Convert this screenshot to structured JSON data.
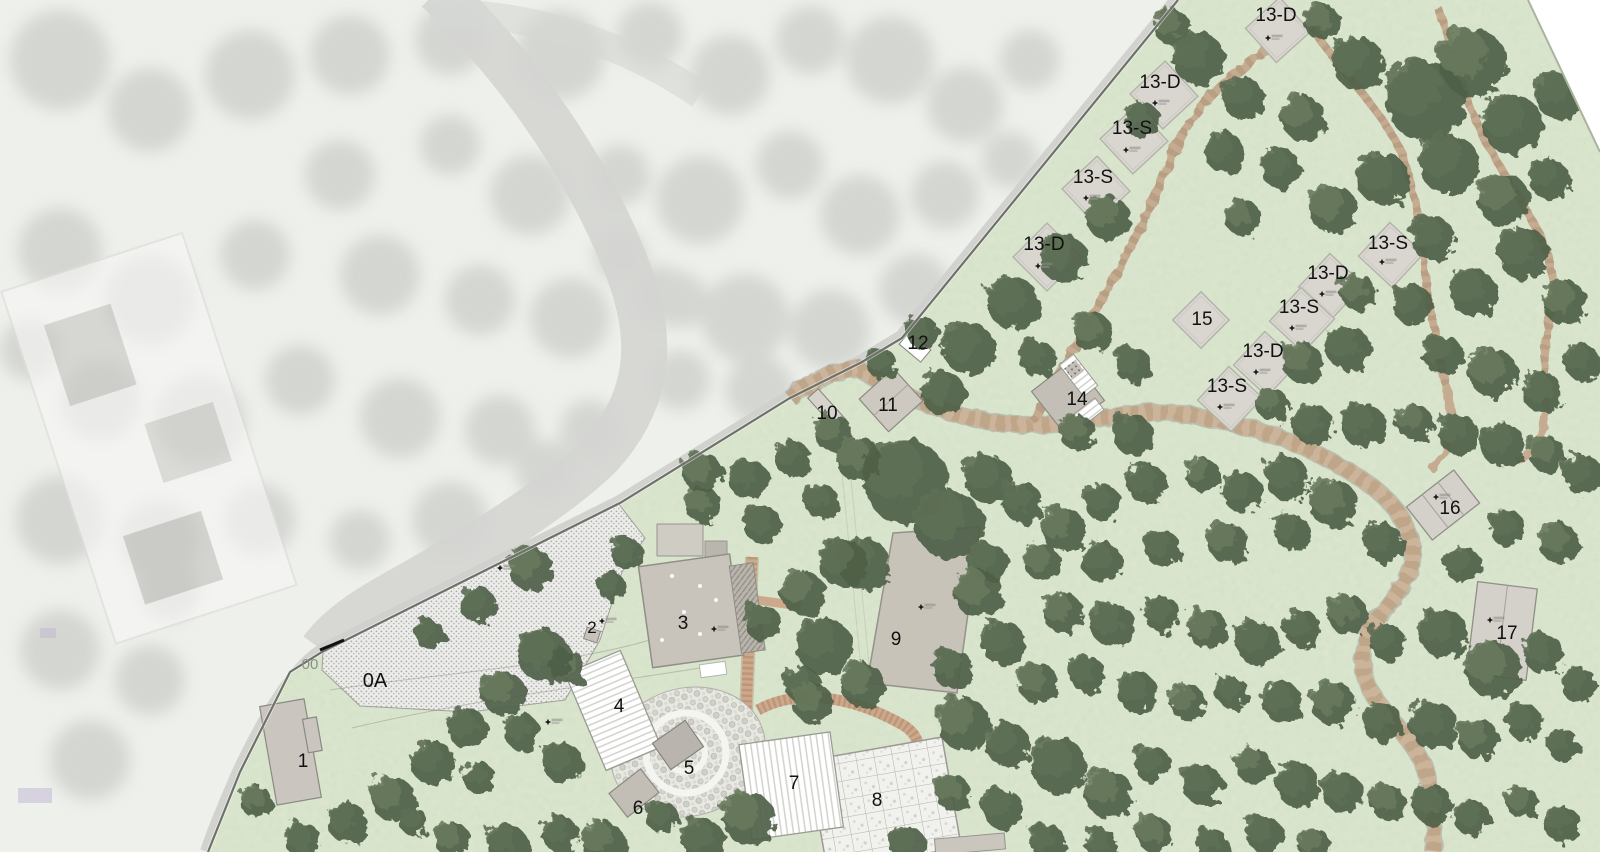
{
  "canvas": {
    "width": 1600,
    "height": 852
  },
  "plan": {
    "type": "landscape-site-masterplan",
    "palette": {
      "grass": "#dce6cf",
      "grass_speckle": "#9cb48b",
      "tree_dark": "#4e5f46",
      "tree_mid": "#5d6f54",
      "photo_bg": "#eef0ec",
      "photo_blob": "#bfc1bd",
      "road": "#d4d5d1",
      "stone_path": "#ccb49b",
      "stone_dash": "#b49878",
      "deck": "#cda98c",
      "building_gray": "#c7c3b9",
      "cabin_fill": "#d9d6d0",
      "plaza_dot": "#ababa5",
      "boundary": "#6f716b",
      "label_black": "#111111",
      "label_gray": "#8b8e87",
      "white_roof": "#ffffff"
    }
  },
  "labels": [
    {
      "id": "cabin-13d-a",
      "text": "13-D",
      "x": 1276,
      "y": 21,
      "fs": 19
    },
    {
      "id": "cabin-13d-b",
      "text": "13-D",
      "x": 1160,
      "y": 88,
      "fs": 19
    },
    {
      "id": "cabin-13s-a",
      "text": "13-S",
      "x": 1132,
      "y": 134,
      "fs": 19
    },
    {
      "id": "cabin-13s-b",
      "text": "13-S",
      "x": 1093,
      "y": 183,
      "fs": 19
    },
    {
      "id": "cabin-13d-c",
      "text": "13-D",
      "x": 1044,
      "y": 250,
      "fs": 19
    },
    {
      "id": "cabin-13s-c",
      "text": "13-S",
      "x": 1388,
      "y": 249,
      "fs": 19
    },
    {
      "id": "cabin-13d-d",
      "text": "13-D",
      "x": 1328,
      "y": 279,
      "fs": 19
    },
    {
      "id": "cabin-13s-d",
      "text": "13-S",
      "x": 1299,
      "y": 313,
      "fs": 19
    },
    {
      "id": "lot-15",
      "text": "15",
      "x": 1202,
      "y": 325,
      "fs": 19
    },
    {
      "id": "cabin-13d-e",
      "text": "13-D",
      "x": 1263,
      "y": 357,
      "fs": 19
    },
    {
      "id": "cabin-13s-e",
      "text": "13-S",
      "x": 1227,
      "y": 392,
      "fs": 19
    },
    {
      "id": "bldg-14",
      "text": "14",
      "x": 1077,
      "y": 405,
      "fs": 19
    },
    {
      "id": "bldg-12",
      "text": "12",
      "x": 918,
      "y": 349,
      "fs": 19
    },
    {
      "id": "bldg-11",
      "text": "11",
      "x": 888,
      "y": 411,
      "fs": 19
    },
    {
      "id": "bldg-10",
      "text": "10",
      "x": 827,
      "y": 419,
      "fs": 19
    },
    {
      "id": "bldg-16",
      "text": "16",
      "x": 1450,
      "y": 514,
      "fs": 19
    },
    {
      "id": "bldg-17",
      "text": "17",
      "x": 1507,
      "y": 639,
      "fs": 19
    },
    {
      "id": "gate-00",
      "text": "00",
      "x": 310,
      "y": 669,
      "fs": 15,
      "color": "#8b8e87"
    },
    {
      "id": "area-0a",
      "text": "0A",
      "x": 375,
      "y": 687,
      "fs": 20
    },
    {
      "id": "bldg-1",
      "text": "1",
      "x": 303,
      "y": 767,
      "fs": 19
    },
    {
      "id": "bldg-2",
      "text": "2",
      "x": 592,
      "y": 633,
      "fs": 17
    },
    {
      "id": "bldg-3",
      "text": "3",
      "x": 683,
      "y": 629,
      "fs": 19
    },
    {
      "id": "bldg-4",
      "text": "4",
      "x": 619,
      "y": 712,
      "fs": 19
    },
    {
      "id": "bldg-5",
      "text": "5",
      "x": 689,
      "y": 774,
      "fs": 19
    },
    {
      "id": "bldg-6",
      "text": "6",
      "x": 638,
      "y": 814,
      "fs": 19
    },
    {
      "id": "bldg-7",
      "text": "7",
      "x": 794,
      "y": 789,
      "fs": 19
    },
    {
      "id": "bldg-8",
      "text": "8",
      "x": 877,
      "y": 806,
      "fs": 19
    },
    {
      "id": "bldg-9",
      "text": "9",
      "x": 896,
      "y": 645,
      "fs": 19
    }
  ],
  "cabins": [
    {
      "label": "13-D",
      "cx": 1278,
      "cy": 30,
      "s": 23,
      "rot": 48
    },
    {
      "label": "13-D",
      "cx": 1164,
      "cy": 95,
      "s": 24,
      "rot": 47
    },
    {
      "label": "13-S",
      "cx": 1134,
      "cy": 140,
      "s": 24,
      "rot": 47
    },
    {
      "label": "13-S",
      "cx": 1096,
      "cy": 190,
      "s": 24,
      "rot": 47
    },
    {
      "label": "13-D",
      "cx": 1047,
      "cy": 257,
      "s": 24,
      "rot": 45
    },
    {
      "label": "13-S",
      "cx": 1391,
      "cy": 255,
      "s": 23,
      "rot": 43
    },
    {
      "label": "13-D",
      "cx": 1331,
      "cy": 286,
      "s": 23,
      "rot": 43
    },
    {
      "label": "13-S",
      "cx": 1302,
      "cy": 320,
      "s": 23,
      "rot": 43
    },
    {
      "label": "13-D",
      "cx": 1266,
      "cy": 364,
      "s": 23,
      "rot": 43
    },
    {
      "label": "13-S",
      "cx": 1230,
      "cy": 399,
      "s": 23,
      "rot": 43
    },
    {
      "label": "15",
      "cx": 1201,
      "cy": 320,
      "s": 20,
      "rot": 45
    }
  ],
  "elevation_markers": [
    {
      "x": 1268,
      "y": 38
    },
    {
      "x": 1155,
      "y": 103
    },
    {
      "x": 1126,
      "y": 150
    },
    {
      "x": 1086,
      "y": 198
    },
    {
      "x": 1038,
      "y": 266
    },
    {
      "x": 1382,
      "y": 262
    },
    {
      "x": 1322,
      "y": 294
    },
    {
      "x": 1292,
      "y": 328
    },
    {
      "x": 1256,
      "y": 372
    },
    {
      "x": 1220,
      "y": 407
    },
    {
      "x": 1436,
      "y": 497
    },
    {
      "x": 1490,
      "y": 620
    },
    {
      "x": 921,
      "y": 607
    },
    {
      "x": 500,
      "y": 568
    },
    {
      "x": 602,
      "y": 621
    },
    {
      "x": 714,
      "y": 629
    },
    {
      "x": 548,
      "y": 722
    }
  ]
}
